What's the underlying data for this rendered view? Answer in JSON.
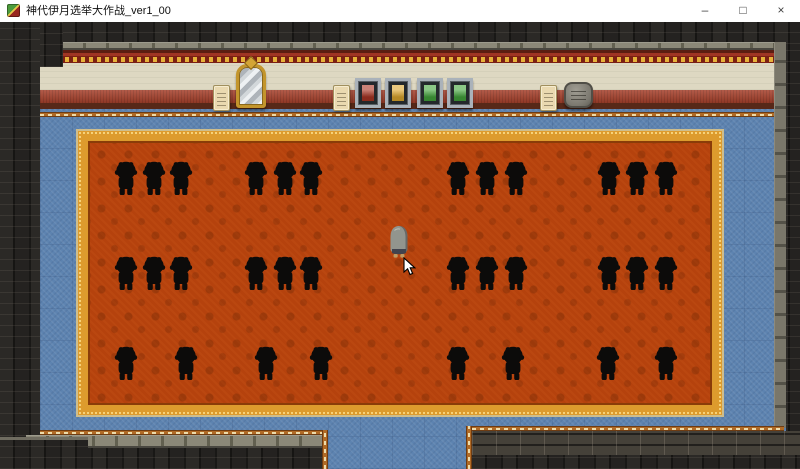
{
  "window": {
    "title": "神代伊月选举大作战_ver1_00",
    "controls": {
      "minimize": "–",
      "maximize": "□",
      "close": "×"
    }
  },
  "game": {
    "scene": "election-assembly-hall",
    "colors": {
      "carpet": "#b5420d",
      "carpet_border": "#dd9b2d",
      "floor_blue": "#5d83b0",
      "wall_cream": "#ded8c2",
      "wall_red": "#a6402b",
      "brick_dark": "#211f1d",
      "silhouette": "#0c0b0a"
    },
    "audience": {
      "rows": [
        {
          "y": 138,
          "xs": [
            113,
            141,
            168,
            243,
            272,
            298,
            445,
            474,
            503,
            596,
            624,
            653
          ]
        },
        {
          "y": 233,
          "xs": [
            113,
            141,
            168,
            243,
            272,
            298,
            445,
            474,
            503,
            596,
            624,
            653
          ]
        },
        {
          "y": 323,
          "xs": [
            113,
            173,
            253,
            308,
            445,
            500,
            595,
            653
          ]
        }
      ]
    },
    "wall_items": [
      {
        "type": "paper",
        "x": 213,
        "y": 63
      },
      {
        "type": "mirror",
        "x": 236,
        "y": 42
      },
      {
        "type": "paper",
        "x": 333,
        "y": 63
      },
      {
        "type": "panel",
        "x": 355,
        "y": 56,
        "color": "#a93524"
      },
      {
        "type": "panel",
        "x": 385,
        "y": 56,
        "color": "#dca72e"
      },
      {
        "type": "panel",
        "x": 417,
        "y": 56,
        "color": "#43a33c"
      },
      {
        "type": "panel",
        "x": 447,
        "y": 56,
        "color": "#43a33c"
      },
      {
        "type": "paper",
        "x": 540,
        "y": 63
      },
      {
        "type": "stone",
        "x": 564,
        "y": 60
      }
    ],
    "player": {
      "x": 386,
      "y": 202
    },
    "cursor": {
      "x": 403,
      "y": 235
    }
  }
}
